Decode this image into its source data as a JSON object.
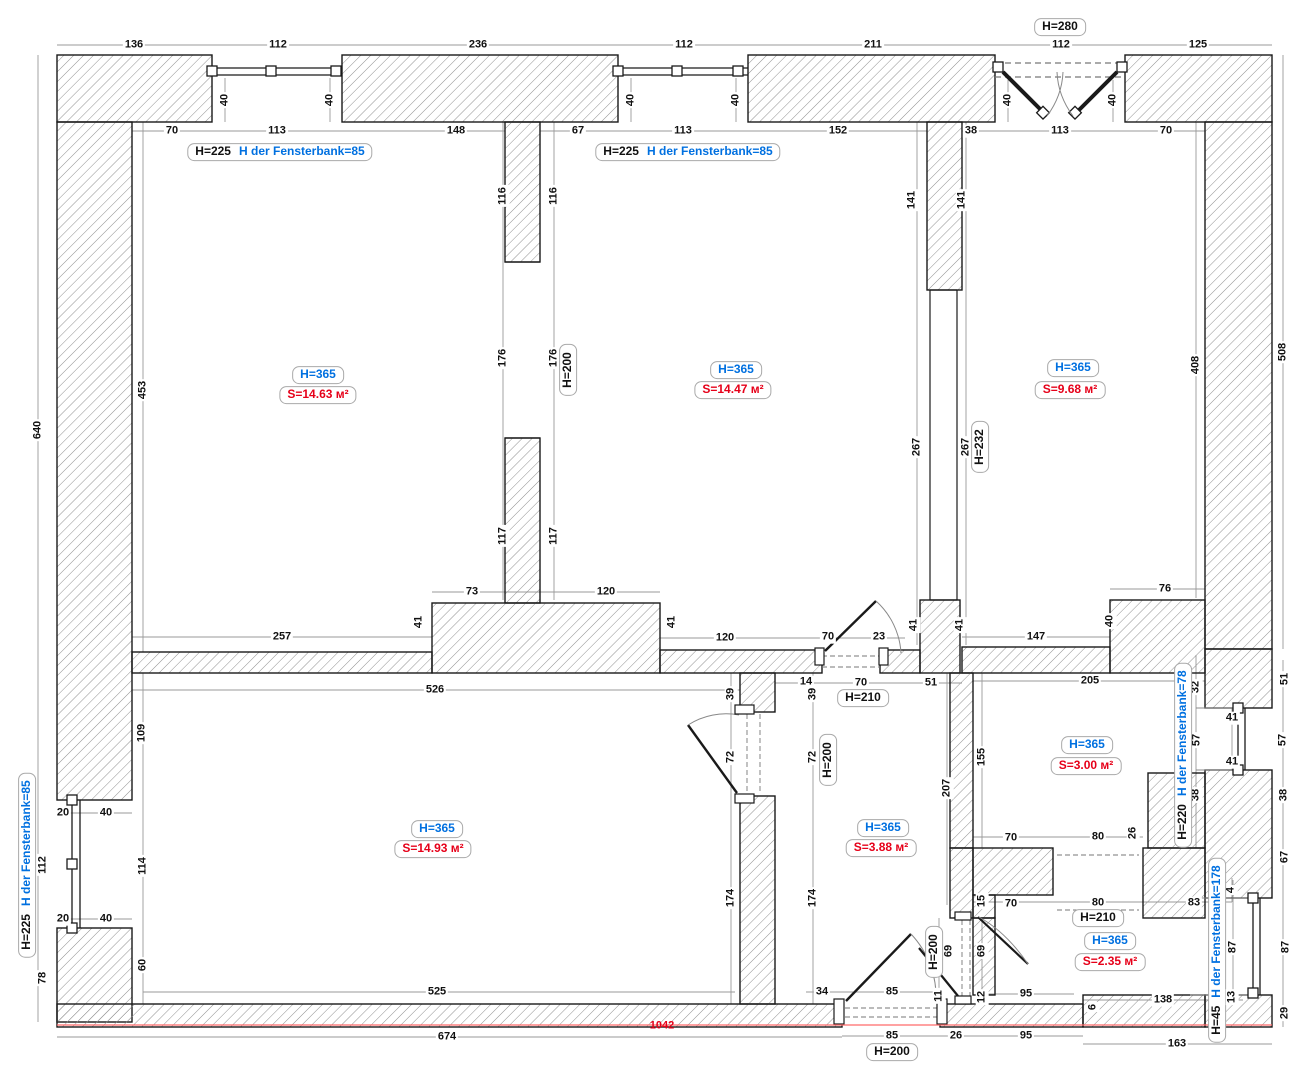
{
  "colors": {
    "wall_stroke": "#1a1a1a",
    "hatch": "#909090",
    "dimension_line": "#999999",
    "room_height_blue": "#0070e0",
    "room_area_red": "#e60019",
    "baseline_red": "#ff6a6a"
  },
  "labels": [
    {
      "t": "136",
      "x": 134,
      "y": 45
    },
    {
      "t": "112",
      "x": 278,
      "y": 45
    },
    {
      "t": "236",
      "x": 478,
      "y": 45
    },
    {
      "t": "112",
      "x": 684,
      "y": 45
    },
    {
      "t": "211",
      "x": 873,
      "y": 45
    },
    {
      "t": "112",
      "x": 1061,
      "y": 45
    },
    {
      "t": "125",
      "x": 1198,
      "y": 45
    },
    {
      "t": "H=280",
      "x": 1060,
      "y": 27,
      "c": "h"
    },
    {
      "t": "70",
      "x": 172,
      "y": 131
    },
    {
      "t": "113",
      "x": 277,
      "y": 131
    },
    {
      "t": "148",
      "x": 456,
      "y": 131
    },
    {
      "t": "67",
      "x": 578,
      "y": 131
    },
    {
      "t": "113",
      "x": 683,
      "y": 131
    },
    {
      "t": "152",
      "x": 838,
      "y": 131
    },
    {
      "t": "38",
      "x": 971,
      "y": 131
    },
    {
      "t": "113",
      "x": 1060,
      "y": 131
    },
    {
      "t": "70",
      "x": 1166,
      "y": 131
    },
    {
      "t": "H=225",
      "t2": "H der Fensterbank=85",
      "x": 280,
      "y": 152,
      "c": "combo"
    },
    {
      "t": "H=225",
      "t2": "H der Fensterbank=85",
      "x": 688,
      "y": 152,
      "c": "combo"
    },
    {
      "t": "40",
      "x": 225,
      "y": 100,
      "r": 1
    },
    {
      "t": "40",
      "x": 330,
      "y": 100,
      "r": 1
    },
    {
      "t": "40",
      "x": 631,
      "y": 100,
      "r": 1
    },
    {
      "t": "40",
      "x": 736,
      "y": 100,
      "r": 1
    },
    {
      "t": "40",
      "x": 1008,
      "y": 100,
      "r": 1
    },
    {
      "t": "40",
      "x": 1113,
      "y": 100,
      "r": 1
    },
    {
      "t": "640",
      "x": 38,
      "y": 430,
      "r": 1
    },
    {
      "t": "453",
      "x": 143,
      "y": 390,
      "r": 1
    },
    {
      "t": "109",
      "x": 142,
      "y": 733,
      "r": 1
    },
    {
      "t": "112",
      "x": 43,
      "y": 865,
      "r": 1
    },
    {
      "t": "114",
      "x": 143,
      "y": 866,
      "r": 1
    },
    {
      "t": "20",
      "x": 63,
      "y": 813
    },
    {
      "t": "40",
      "x": 106,
      "y": 813
    },
    {
      "t": "20",
      "x": 63,
      "y": 919
    },
    {
      "t": "40",
      "x": 106,
      "y": 919
    },
    {
      "t": "H=225",
      "t2": "H der Fensterbank=85",
      "x": 27,
      "y": 865,
      "r": 1,
      "c": "combo"
    },
    {
      "t": "78",
      "x": 43,
      "y": 978,
      "r": 1
    },
    {
      "t": "60",
      "x": 143,
      "y": 965,
      "r": 1
    },
    {
      "t": "H=365",
      "x": 318,
      "y": 375,
      "c": "blue"
    },
    {
      "t": "S=14.63 м²",
      "x": 318,
      "y": 395,
      "c": "red"
    },
    {
      "t": "H=365",
      "x": 736,
      "y": 370,
      "c": "blue"
    },
    {
      "t": "S=14.47 м²",
      "x": 733,
      "y": 390,
      "c": "red"
    },
    {
      "t": "H=365",
      "x": 1073,
      "y": 368,
      "c": "blue"
    },
    {
      "t": "S=9.68 м²",
      "x": 1070,
      "y": 390,
      "c": "red"
    },
    {
      "t": "H=365",
      "x": 437,
      "y": 829,
      "c": "blue"
    },
    {
      "t": "S=14.93 м²",
      "x": 433,
      "y": 849,
      "c": "red"
    },
    {
      "t": "H=365",
      "x": 883,
      "y": 828,
      "c": "blue"
    },
    {
      "t": "S=3.88 м²",
      "x": 881,
      "y": 848,
      "c": "red"
    },
    {
      "t": "H=365",
      "x": 1087,
      "y": 745,
      "c": "blue"
    },
    {
      "t": "S=3.00 м²",
      "x": 1086,
      "y": 766,
      "c": "red"
    },
    {
      "t": "H=365",
      "x": 1110,
      "y": 941,
      "c": "blue"
    },
    {
      "t": "S=2.35 м²",
      "x": 1110,
      "y": 962,
      "c": "red"
    },
    {
      "t": "116",
      "x": 503,
      "y": 196,
      "r": 1
    },
    {
      "t": "116",
      "x": 554,
      "y": 196,
      "r": 1
    },
    {
      "t": "176",
      "x": 503,
      "y": 358,
      "r": 1
    },
    {
      "t": "176",
      "x": 554,
      "y": 358,
      "r": 1
    },
    {
      "t": "H=200",
      "x": 568,
      "y": 370,
      "r": 1,
      "c": "h"
    },
    {
      "t": "117",
      "x": 503,
      "y": 536,
      "r": 1
    },
    {
      "t": "117",
      "x": 554,
      "y": 536,
      "r": 1
    },
    {
      "t": "141",
      "x": 912,
      "y": 200,
      "r": 1
    },
    {
      "t": "141",
      "x": 962,
      "y": 200,
      "r": 1
    },
    {
      "t": "267",
      "x": 917,
      "y": 447,
      "r": 1
    },
    {
      "t": "267",
      "x": 966,
      "y": 447,
      "r": 1
    },
    {
      "t": "H=232",
      "x": 980,
      "y": 447,
      "r": 1,
      "c": "h"
    },
    {
      "t": "408",
      "x": 1196,
      "y": 365,
      "r": 1
    },
    {
      "t": "508",
      "x": 1283,
      "y": 352,
      "r": 1
    },
    {
      "t": "257",
      "x": 282,
      "y": 637
    },
    {
      "t": "41",
      "x": 419,
      "y": 622,
      "r": 1
    },
    {
      "t": "73",
      "x": 472,
      "y": 592
    },
    {
      "t": "120",
      "x": 606,
      "y": 592
    },
    {
      "t": "41",
      "x": 672,
      "y": 622,
      "r": 1
    },
    {
      "t": "120",
      "x": 725,
      "y": 638
    },
    {
      "t": "70",
      "x": 828,
      "y": 637
    },
    {
      "t": "23",
      "x": 879,
      "y": 637
    },
    {
      "t": "14",
      "x": 806,
      "y": 682
    },
    {
      "t": "70",
      "x": 861,
      "y": 683
    },
    {
      "t": "51",
      "x": 931,
      "y": 683
    },
    {
      "t": "H=210",
      "x": 863,
      "y": 698,
      "c": "h"
    },
    {
      "t": "526",
      "x": 435,
      "y": 690
    },
    {
      "t": "39",
      "x": 731,
      "y": 694,
      "r": 1
    },
    {
      "t": "39",
      "x": 813,
      "y": 694,
      "r": 1
    },
    {
      "t": "72",
      "x": 731,
      "y": 757,
      "r": 1
    },
    {
      "t": "72",
      "x": 813,
      "y": 757,
      "r": 1
    },
    {
      "t": "H=200",
      "x": 828,
      "y": 760,
      "r": 1,
      "c": "h"
    },
    {
      "t": "174",
      "x": 731,
      "y": 898,
      "r": 1
    },
    {
      "t": "174",
      "x": 813,
      "y": 898,
      "r": 1
    },
    {
      "t": "207",
      "x": 947,
      "y": 788,
      "r": 1
    },
    {
      "t": "155",
      "x": 982,
      "y": 757,
      "r": 1
    },
    {
      "t": "41",
      "x": 914,
      "y": 625,
      "r": 1
    },
    {
      "t": "41",
      "x": 960,
      "y": 625,
      "r": 1
    },
    {
      "t": "147",
      "x": 1036,
      "y": 637
    },
    {
      "t": "40",
      "x": 1110,
      "y": 621,
      "r": 1
    },
    {
      "t": "76",
      "x": 1165,
      "y": 589
    },
    {
      "t": "205",
      "x": 1090,
      "y": 681
    },
    {
      "t": "70",
      "x": 1011,
      "y": 838
    },
    {
      "t": "80",
      "x": 1098,
      "y": 837
    },
    {
      "t": "26",
      "x": 1133,
      "y": 833,
      "r": 1
    },
    {
      "t": "32",
      "x": 1196,
      "y": 687,
      "r": 1
    },
    {
      "t": "57",
      "x": 1197,
      "y": 740,
      "r": 1
    },
    {
      "t": "38",
      "x": 1196,
      "y": 795,
      "r": 1
    },
    {
      "t": "41",
      "x": 1232,
      "y": 718
    },
    {
      "t": "41",
      "x": 1232,
      "y": 762
    },
    {
      "t": "H=220",
      "t2": "H der Fensterbank=78",
      "x": 1183,
      "y": 755,
      "r": 1,
      "c": "combo"
    },
    {
      "t": "51",
      "x": 1285,
      "y": 679,
      "r": 1
    },
    {
      "t": "57",
      "x": 1283,
      "y": 740,
      "r": 1
    },
    {
      "t": "38",
      "x": 1284,
      "y": 795,
      "r": 1
    },
    {
      "t": "67",
      "x": 1285,
      "y": 857,
      "r": 1
    },
    {
      "t": "4",
      "x": 1231,
      "y": 890,
      "r": 1
    },
    {
      "t": "87",
      "x": 1286,
      "y": 947,
      "r": 1
    },
    {
      "t": "29",
      "x": 1285,
      "y": 1013,
      "r": 1
    },
    {
      "t": "15",
      "x": 982,
      "y": 901,
      "r": 1
    },
    {
      "t": "70",
      "x": 1011,
      "y": 904
    },
    {
      "t": "80",
      "x": 1098,
      "y": 903
    },
    {
      "t": "83",
      "x": 1194,
      "y": 903
    },
    {
      "t": "H=210",
      "x": 1098,
      "y": 918,
      "c": "h"
    },
    {
      "t": "69",
      "x": 949,
      "y": 951,
      "r": 1
    },
    {
      "t": "69",
      "x": 982,
      "y": 951,
      "r": 1
    },
    {
      "t": "H=200",
      "x": 934,
      "y": 952,
      "r": 1,
      "c": "h"
    },
    {
      "t": "11",
      "x": 939,
      "y": 996,
      "r": 1
    },
    {
      "t": "12",
      "x": 982,
      "y": 997,
      "r": 1
    },
    {
      "t": "95",
      "x": 1026,
      "y": 994
    },
    {
      "t": "138",
      "x": 1163,
      "y": 1000
    },
    {
      "t": "6",
      "x": 1093,
      "y": 1007,
      "r": 1
    },
    {
      "t": "H=45",
      "t2": "H der Fensterbank=178",
      "x": 1217,
      "y": 950,
      "r": 1,
      "c": "combo"
    },
    {
      "t": "87",
      "x": 1233,
      "y": 947,
      "r": 1
    },
    {
      "t": "13",
      "x": 1232,
      "y": 997,
      "r": 1
    },
    {
      "t": "34",
      "x": 822,
      "y": 992
    },
    {
      "t": "85",
      "x": 892,
      "y": 992
    },
    {
      "t": "85",
      "x": 892,
      "y": 1036
    },
    {
      "t": "26",
      "x": 956,
      "y": 1036
    },
    {
      "t": "95",
      "x": 1026,
      "y": 1036
    },
    {
      "t": "H=200",
      "x": 892,
      "y": 1052,
      "c": "h"
    },
    {
      "t": "163",
      "x": 1177,
      "y": 1044
    },
    {
      "t": "525",
      "x": 437,
      "y": 992
    },
    {
      "t": "674",
      "x": 447,
      "y": 1037
    },
    {
      "t": "1042",
      "x": 662,
      "y": 1026,
      "c": "plainred"
    }
  ]
}
